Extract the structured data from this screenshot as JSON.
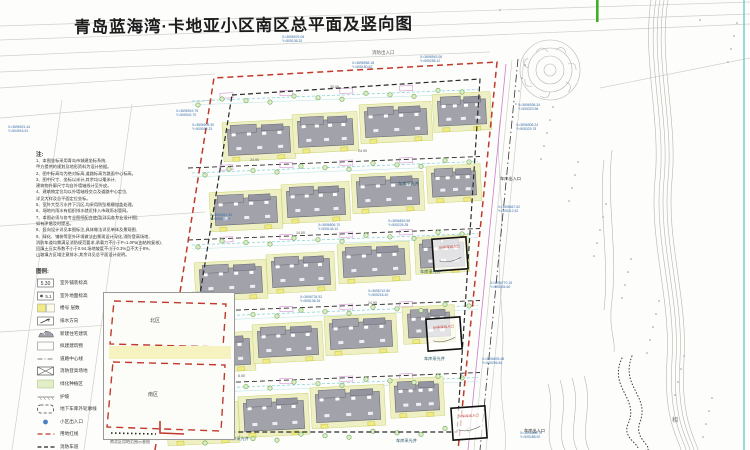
{
  "title": "青岛蓝海湾·卡地亚小区南区总平面及竖向图",
  "top_label": "消防出入口",
  "notes": {
    "heading": "注:",
    "lines": [
      "1、本图坐标采用青岛市城建坐标系统,",
      "    甲方提供的规划及地形资料为设计依据。",
      "2、图中标高均为绝对标高,道路标高为路面中心标高。",
      "3、图中尺寸、坐标以米计,其余均以毫米计,",
      "    建筑物外廓尺寸均自外墙轴线计至外皮。",
      "4、建筑物定位均以外墙轴线交点及道路中心定位,",
      "    详见大样及总平面定位坐标。",
      "5、室外大型污水井下沉区,均采用防坠格栅加盖处理。",
      "6、场地内雨水有组织排水就近排入市政雨水管网。",
      "7、本图必须与各专业图纸配合使用(详见各专业设计图),",
      "    如有矛盾及时提出。",
      "8、竖向设计详见本图标注,具体做法详见单体及景观图,",
      "9、绿化、铺装等室外环境做法由景观设计深化,消防登高场地、",
      "    消防车道均需满足消防规范要求,承载力不小于P=1.0Pa(由结构复核),",
      "    回填土压实系数不小于0.94,场地坡度不小于0.3%且不大于8%,",
      "    山坡填方区域注意排水,其余详见总平面设计说明。"
    ]
  },
  "legend": {
    "heading": "图例:",
    "items": [
      {
        "icon": "elev-pave-icon",
        "label": "室外铺装标高"
      },
      {
        "icon": "elev-ground-icon",
        "label": "室外地面标高"
      },
      {
        "icon": "bldg-no-icon",
        "label": "楼号  层数"
      },
      {
        "icon": "drain-arrow-icon",
        "label": "排水方向"
      },
      {
        "icon": "new-bldg-icon",
        "label": "新建住宅建筑"
      },
      {
        "icon": "planned-bldg-icon",
        "label": "拟建建筑物"
      },
      {
        "icon": "centerline-icon",
        "label": "道路中心线"
      },
      {
        "icon": "fire-pad-icon",
        "label": "消防登高场地"
      },
      {
        "icon": "green-icon",
        "label": "绿化种植区"
      },
      {
        "icon": "slope-icon",
        "label": "护坡"
      },
      {
        "icon": "garage-line-icon",
        "label": "地下车库外轮廓线"
      },
      {
        "icon": "entrance-icon",
        "label": "小区出入口"
      },
      {
        "icon": "redline-icon",
        "label": "用地红线"
      },
      {
        "icon": "firelane-icon",
        "label": "消防车道"
      }
    ]
  },
  "keymap": {
    "north_label": "北区",
    "south_label": "南区",
    "caption": "南北区用地范围示意图"
  },
  "site": {
    "garage_boxes": [
      {
        "x": 433,
        "y": 238,
        "label": "5#车库出入口"
      },
      {
        "x": 427,
        "y": 318,
        "label": "6#车库出入口"
      },
      {
        "x": 452,
        "y": 407,
        "label": "7#车库出入口"
      }
    ],
    "lightwell_labels": [
      {
        "x": 398,
        "y": 185,
        "t": "车库采光井"
      },
      {
        "x": 420,
        "y": 273,
        "t": "车库采光井"
      },
      {
        "x": 424,
        "y": 360,
        "t": "车库采光井"
      },
      {
        "x": 228,
        "y": 440,
        "t": "车库采光井"
      },
      {
        "x": 396,
        "y": 442,
        "t": "车库采光井"
      }
    ],
    "entrance_labels": [
      {
        "x": 500,
        "y": 180,
        "t": "车库出入口"
      },
      {
        "x": 524,
        "y": 432,
        "t": "车库出入口"
      }
    ],
    "dim_labels": [
      {
        "x": 250,
        "y": 161,
        "t": "24.90"
      },
      {
        "x": 358,
        "y": 152,
        "t": "24.90"
      },
      {
        "x": 296,
        "y": 234,
        "t": "14.00"
      },
      {
        "x": 368,
        "y": 304,
        "t": "24.90"
      },
      {
        "x": 238,
        "y": 377,
        "t": "6.00"
      },
      {
        "x": 330,
        "y": 88,
        "t": "30.00"
      }
    ],
    "coord_labels": [
      {
        "x": 282,
        "y": 38,
        "a": "X=3696976.08",
        "b": "Y=505136.32"
      },
      {
        "x": 352,
        "y": 64,
        "a": "X=3696958.18",
        "b": "Y=505180.62"
      },
      {
        "x": 420,
        "y": 58,
        "a": "X=3696943.06",
        "b": "Y=505258.12"
      },
      {
        "x": 176,
        "y": 112,
        "a": "X=3696919.75",
        "b": "Y=505042.70"
      },
      {
        "x": 192,
        "y": 126,
        "a": "X=3696905.30",
        "b": "Y=505052.23"
      },
      {
        "x": 8,
        "y": 128,
        "a": "X=3696921.44",
        "b": "Y=504916.51"
      },
      {
        "x": 518,
        "y": 106,
        "a": "X=3696936.34",
        "b": "Y=505323.96"
      },
      {
        "x": 516,
        "y": 126,
        "a": "X=3696908.24",
        "b": "Y=505329.78"
      },
      {
        "x": 210,
        "y": 216,
        "a": "X=3696812.30",
        "b": "Y=505035.90"
      },
      {
        "x": 192,
        "y": 294,
        "a": "X=3696738.55",
        "b": "Y=505028.15"
      },
      {
        "x": 176,
        "y": 372,
        "a": "X=3696660.92",
        "b": "Y=505020.40"
      },
      {
        "x": 158,
        "y": 436,
        "a": "X=3696592.06",
        "b": "Y=505013.70"
      },
      {
        "x": 498,
        "y": 208,
        "a": "X=3696847.62",
        "b": "Y=505312.52"
      },
      {
        "x": 490,
        "y": 284,
        "a": "X=3696770.15",
        "b": "Y=505304.60"
      },
      {
        "x": 482,
        "y": 360,
        "a": "X=3696693.48",
        "b": "Y=505296.84"
      },
      {
        "x": 520,
        "y": 434,
        "a": "X=3696608.70",
        "b": "Y=505288.92"
      },
      {
        "x": 318,
        "y": 226,
        "a": "X=3696806.70",
        "b": "Y=505146.10"
      },
      {
        "x": 388,
        "y": 222,
        "a": "X=3696815.95",
        "b": "Y=505226.35"
      },
      {
        "x": 300,
        "y": 298,
        "a": "X=3696734.52",
        "b": "Y=505138.26"
      },
      {
        "x": 368,
        "y": 292,
        "a": "X=3696742.80",
        "b": "Y=505218.40"
      }
    ],
    "misc_label": {
      "x": 672,
      "y": 422,
      "t": "相"
    },
    "buildings": [
      {
        "x": 228,
        "y": 128,
        "w": 62,
        "h": 26
      },
      {
        "x": 298,
        "y": 120,
        "w": 55,
        "h": 26
      },
      {
        "x": 365,
        "y": 110,
        "w": 62,
        "h": 26
      },
      {
        "x": 438,
        "y": 100,
        "w": 48,
        "h": 25
      },
      {
        "x": 215,
        "y": 198,
        "w": 62,
        "h": 26
      },
      {
        "x": 287,
        "y": 190,
        "w": 58,
        "h": 26
      },
      {
        "x": 357,
        "y": 180,
        "w": 62,
        "h": 26
      },
      {
        "x": 432,
        "y": 172,
        "w": 44,
        "h": 24
      },
      {
        "x": 200,
        "y": 268,
        "w": 62,
        "h": 26
      },
      {
        "x": 272,
        "y": 260,
        "w": 58,
        "h": 26
      },
      {
        "x": 343,
        "y": 250,
        "w": 62,
        "h": 26
      },
      {
        "x": 420,
        "y": 243,
        "w": 44,
        "h": 24
      },
      {
        "x": 188,
        "y": 340,
        "w": 62,
        "h": 26
      },
      {
        "x": 258,
        "y": 330,
        "w": 60,
        "h": 26
      },
      {
        "x": 330,
        "y": 322,
        "w": 62,
        "h": 26
      },
      {
        "x": 408,
        "y": 313,
        "w": 42,
        "h": 24
      },
      {
        "x": 172,
        "y": 410,
        "w": 62,
        "h": 28
      },
      {
        "x": 244,
        "y": 402,
        "w": 60,
        "h": 28
      },
      {
        "x": 316,
        "y": 393,
        "w": 64,
        "h": 28
      },
      {
        "x": 395,
        "y": 385,
        "w": 44,
        "h": 26
      }
    ]
  },
  "colors": {
    "boundary_red": "#c0392b",
    "road_dash": "#2a2a2a",
    "building_gray": "#a2a2aa",
    "pad_yellow": "#eef0c4",
    "lightwell_yellow": "#f1ec82",
    "tree_green": "#6aa84f",
    "lane_cyan": "#8fd4dc",
    "coord_text": "#3a6ea8",
    "contour_gray": "#b5b5b0",
    "teal_edge": "#66c8c8",
    "green_marker": "#3fae29",
    "magenta": "#cc7fc8"
  }
}
